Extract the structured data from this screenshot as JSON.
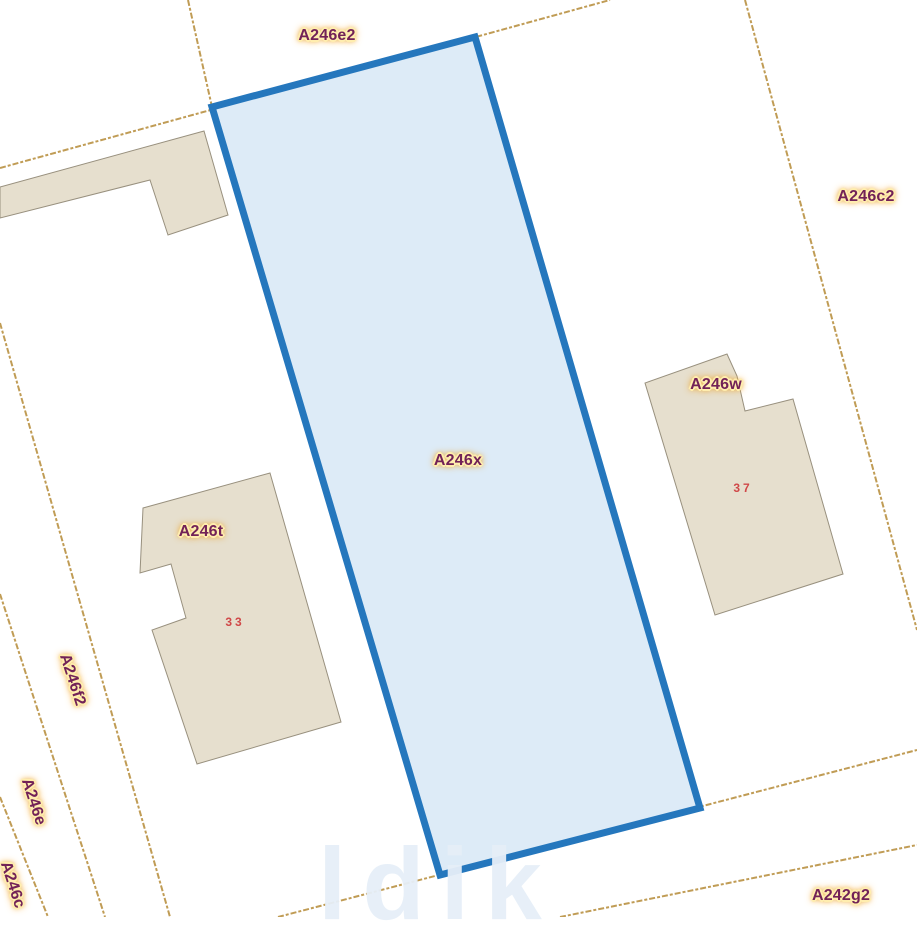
{
  "map": {
    "type": "cadastral-parcel-map",
    "selected_parcel": "A246x",
    "parcel_labels": {
      "a246e2": "A246e2",
      "a246c2": "A246c2",
      "a246w": "A246w",
      "a246x": "A246x",
      "a246t": "A246t",
      "a246f2": "A246f2",
      "a246e": "A246e",
      "a246c": "A246c",
      "a242g2": "A242g2"
    },
    "house_numbers": {
      "n33": "33",
      "n37": "37"
    },
    "watermark_fragment": "ldik"
  },
  "colors": {
    "background": "#ffffff",
    "selected-stroke": "#2577bd",
    "selected-fill": "#ddebf7",
    "boundary-line": "#c09c55",
    "building-fill": "#e6dfce",
    "building-stroke": "#98907e",
    "label-text": "#722257",
    "label-halo": "#ffedae",
    "label-halo-edge": "#eda834",
    "house-number": "#d04848"
  }
}
